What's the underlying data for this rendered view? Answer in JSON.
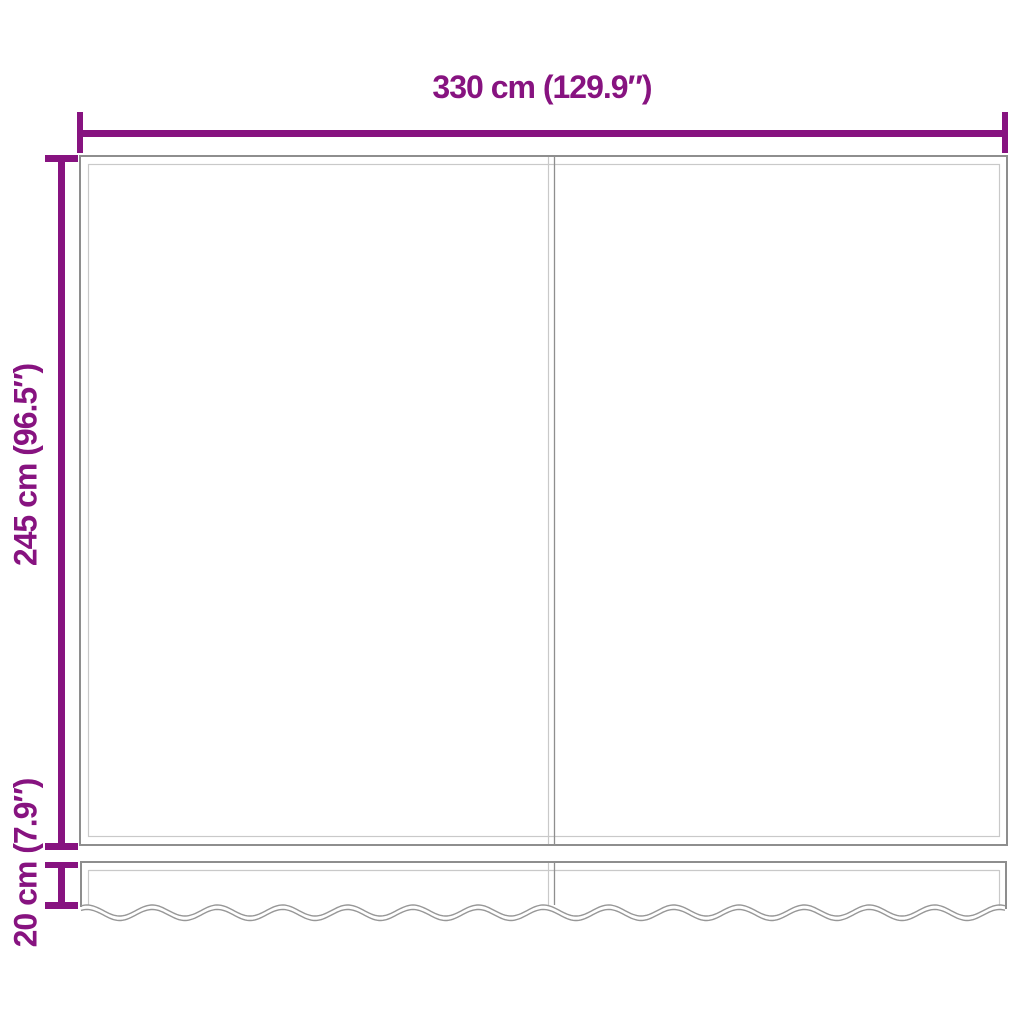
{
  "diagram": {
    "type": "product-dimension-diagram",
    "subject": "awning-replacement-fabric-with-valance",
    "labels": {
      "width": "330 cm (129.9″)",
      "height": "245 cm (96.5″)",
      "valance_height": "20 cm (7.9″)"
    },
    "dimensions": {
      "width_cm": 330,
      "width_in": 129.9,
      "height_cm": 245,
      "height_in": 96.5,
      "valance_cm": 20,
      "valance_in": 7.9
    },
    "colors": {
      "accent": "#871380",
      "outline_dark": "#8e8e8e",
      "outline_light": "#c9c9c9",
      "wave_line": "#979797",
      "background": "#ffffff"
    }
  }
}
